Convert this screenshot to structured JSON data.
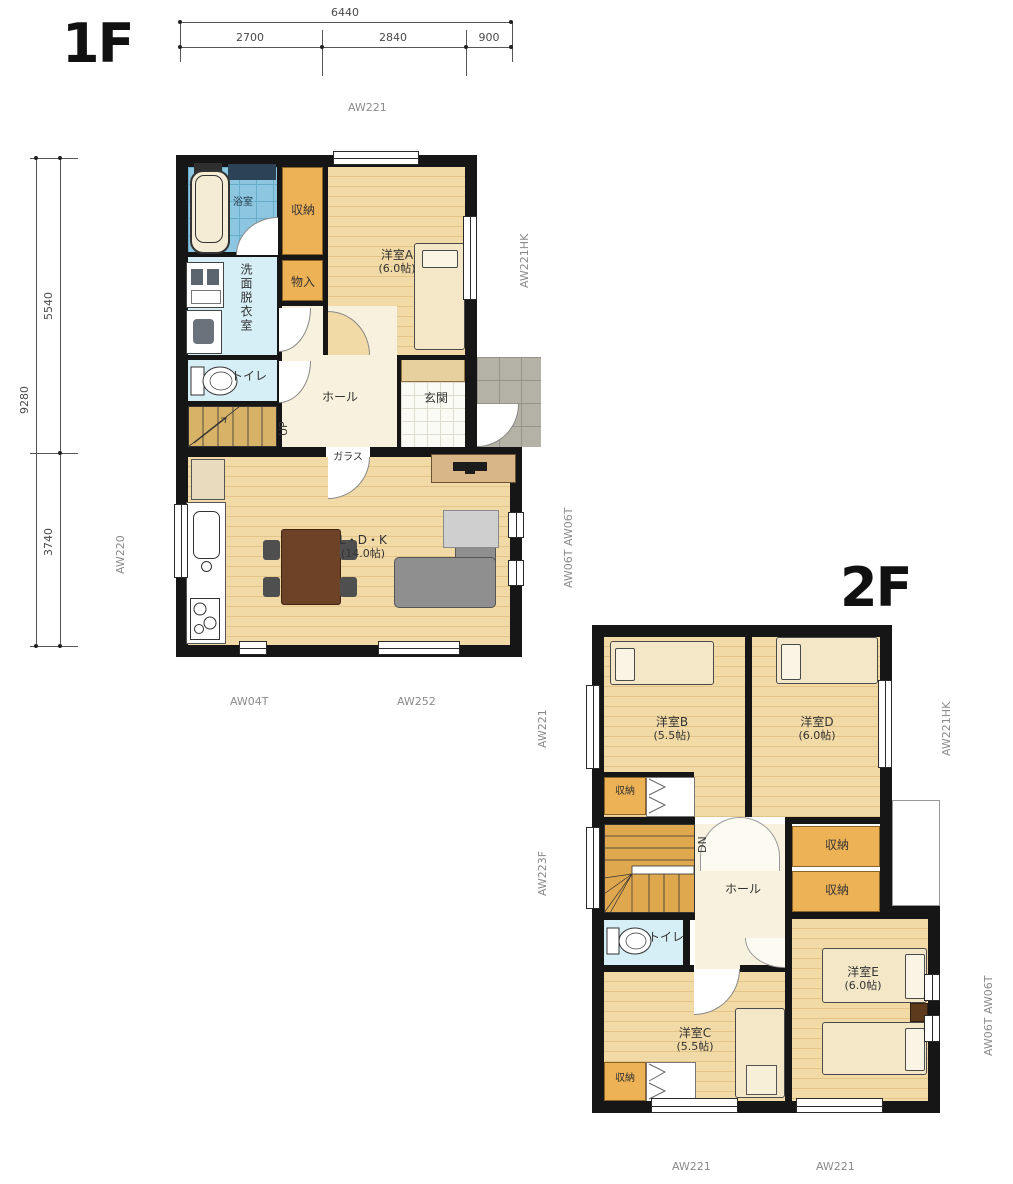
{
  "colors": {
    "wall": "#161616",
    "wood_floor": "#f2daa6",
    "storage_orange": "#edb156",
    "stairs_tan_1f": "#d8b266",
    "stairs_orange_2f": "#dfa74e",
    "bath_blue": "#8cc6e0",
    "wet_room_cyan": "#d6eef6",
    "hall_cream": "#f8f1dd",
    "entry_tile_white": "#fbfbf5",
    "porch_gray": "#b4b1a6",
    "furniture_beige": "#f3e7c8",
    "sofa_gray": "#8f8f8f",
    "table_brown": "#6e4226",
    "annotation_gray": "#8a8a8a"
  },
  "f1": {
    "title": "1F",
    "dims": {
      "w_total": "6440",
      "w1": "2700",
      "w2": "2840",
      "w3": "900",
      "h_total": "9280",
      "h1": "5540",
      "h2": "3740"
    },
    "win": {
      "top": "AW221",
      "right_a": "AW221HK",
      "left": "AW220",
      "right_ldk": "AW06T  AW06T",
      "bottom_1": "AW04T",
      "bottom_2": "AW252"
    },
    "rooms": {
      "bath": "浴室",
      "closet": "収納",
      "room_a": "洋室A",
      "room_a_size": "(6.0帖)",
      "monoire": "物入",
      "wash": "洗面脱衣室",
      "toilet": "トイレ",
      "hall": "ホール",
      "up": "UP",
      "genkan": "玄関",
      "glass": "ガラス",
      "ldk": "L・D・K",
      "ldk_size": "(14.0帖)"
    }
  },
  "f2": {
    "title": "2F",
    "win": {
      "left_1": "AW221",
      "left_2": "AW223F",
      "right_1": "AW221HK",
      "right_2": "AW06T  AW06T",
      "bottom_1": "AW221",
      "bottom_2": "AW221"
    },
    "rooms": {
      "room_b": "洋室B",
      "room_b_size": "(5.5帖)",
      "room_d": "洋室D",
      "room_d_size": "(6.0帖)",
      "closet_b": "収納",
      "dn": "DN",
      "hall": "ホール",
      "closet_r1": "収納",
      "closet_r2": "収納",
      "toilet": "トイレ",
      "room_c": "洋室C",
      "room_c_size": "(5.5帖)",
      "closet_c": "収納",
      "room_e": "洋室E",
      "room_e_size": "(6.0帖)"
    }
  }
}
